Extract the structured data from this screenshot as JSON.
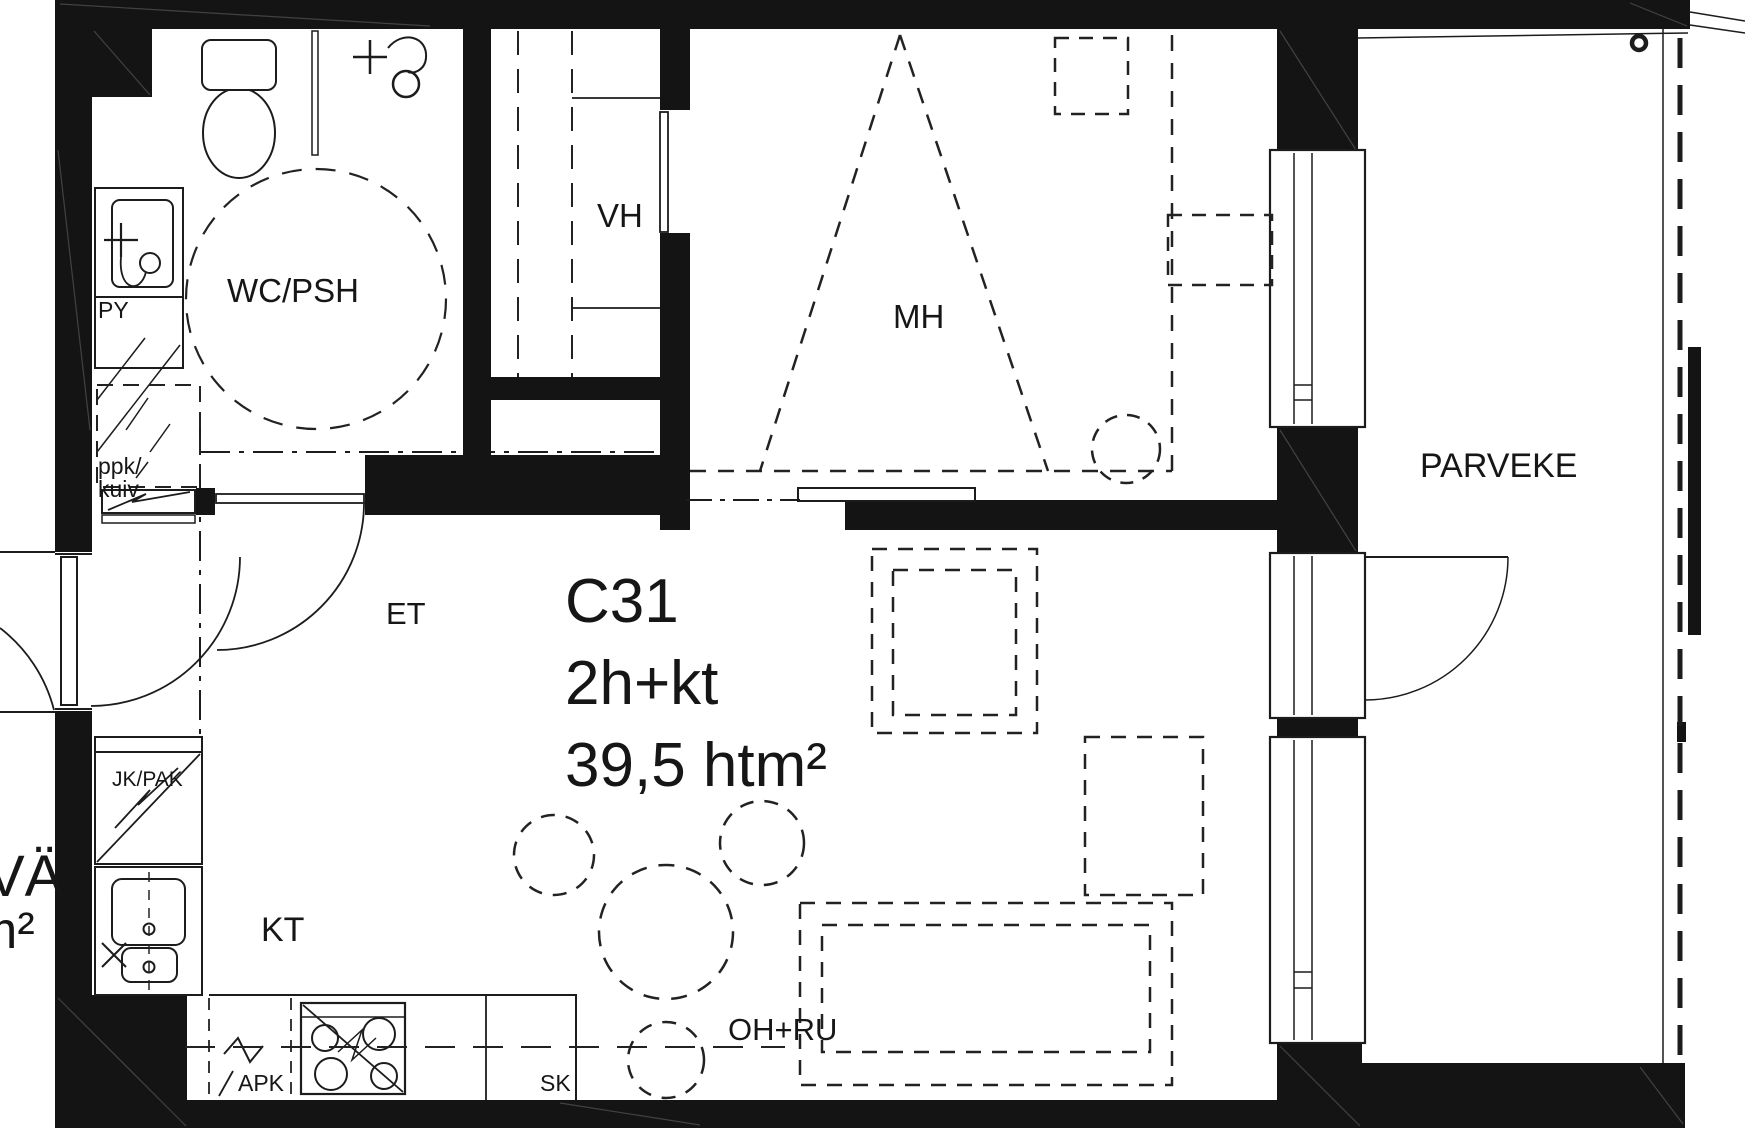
{
  "apartment": {
    "id": "C31",
    "type": "2h+kt",
    "area": "39,5 htm²"
  },
  "rooms": {
    "bathroom": "WC/PSH",
    "closet": "VH",
    "bedroom": "MH",
    "entry": "ET",
    "kitchen": "KT",
    "living": "OH+RU",
    "balcony": "PARVEKE"
  },
  "fixtures": {
    "washbasin": "PY",
    "laundry_line1": "ppk/",
    "laundry_line2": "kuiv",
    "fridge": "JK/PAK",
    "dishwasher": "APK",
    "cabinet": "SK"
  },
  "partial_labels": {
    "left_edge_top": "VÄ",
    "left_edge_bottom": "m²"
  },
  "colors": {
    "wall": "#141414",
    "line": "#1c1c1c",
    "background": "#ffffff"
  }
}
